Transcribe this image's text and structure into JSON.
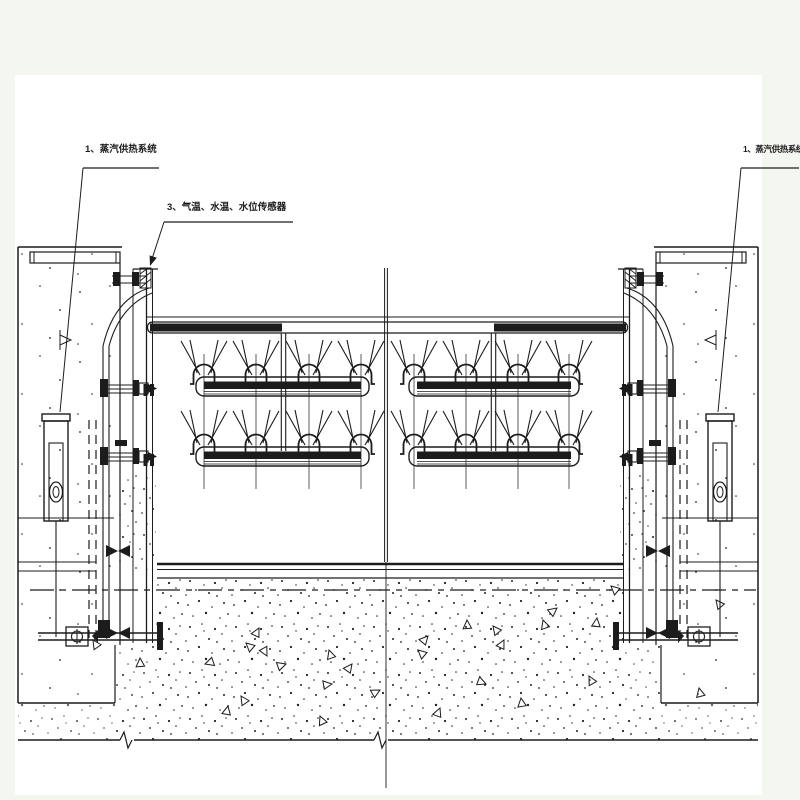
{
  "colors": {
    "bg": "#f4f7ef",
    "paper": "#ffffff",
    "ink": "#1c1c1c",
    "rod": "#4a4a4a"
  },
  "labels": {
    "steam_system_left": "1、蒸汽供热系统",
    "sensor_line": "3、气温、水温、水位传感器",
    "steam_system_right": "1、蒸汽供热系统"
  }
}
